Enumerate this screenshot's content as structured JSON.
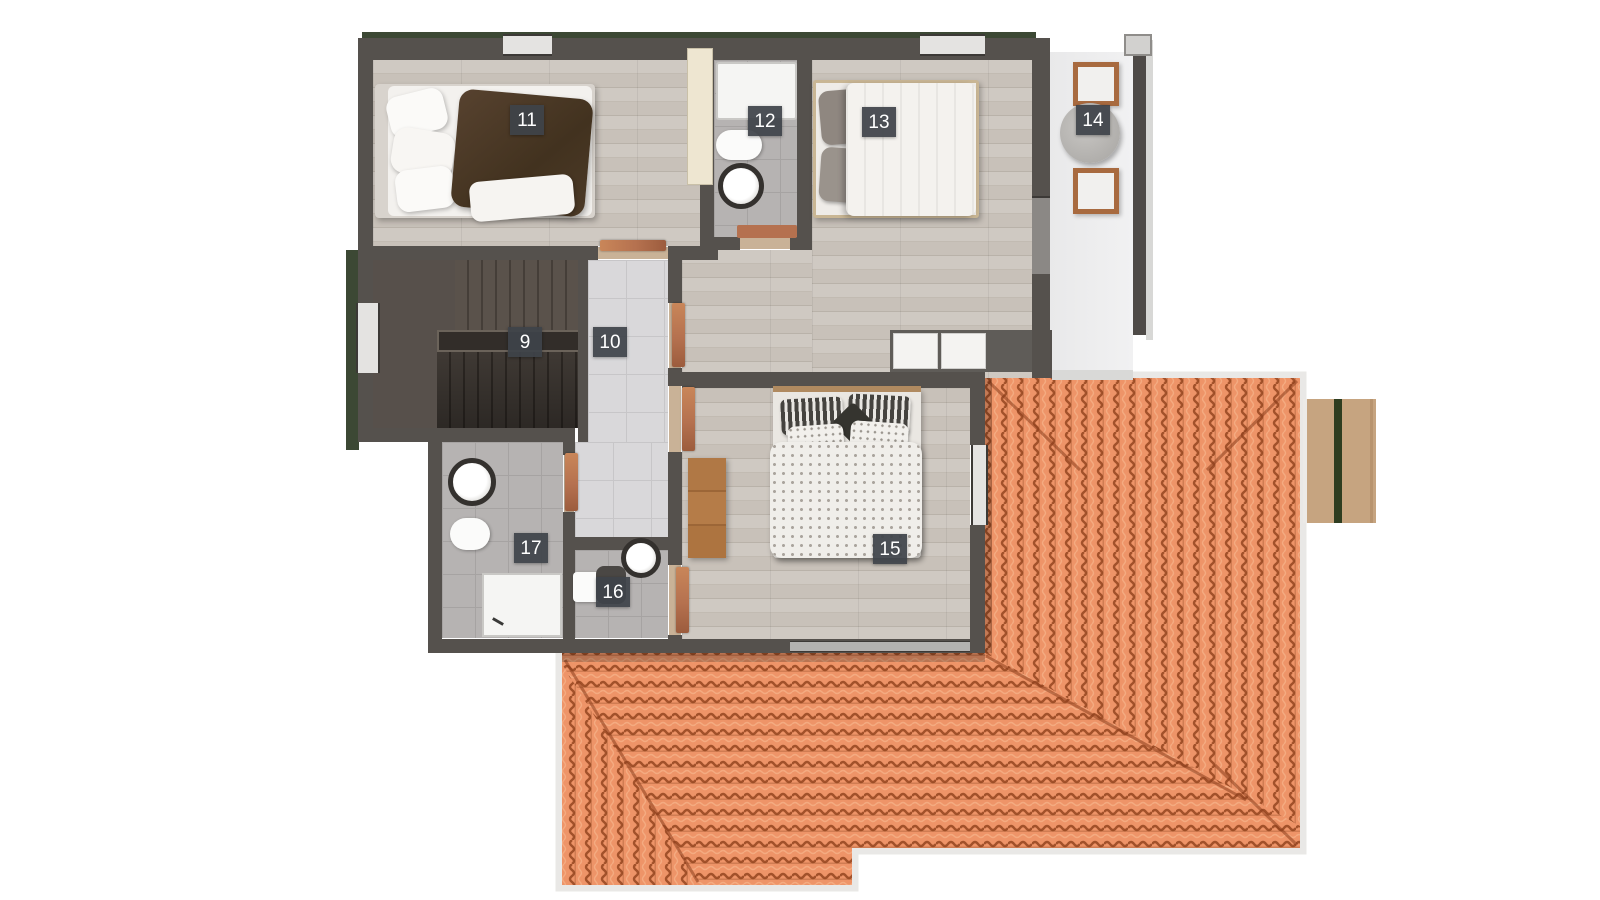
{
  "rooms": [
    {
      "label": "9",
      "kind": "staircase"
    },
    {
      "label": "10",
      "kind": "hallway"
    },
    {
      "label": "11",
      "kind": "bedroom with bed"
    },
    {
      "label": "12",
      "kind": "bathroom with tub, toilet, sink"
    },
    {
      "label": "13",
      "kind": "bedroom with double bed"
    },
    {
      "label": "14",
      "kind": "balcony with two chairs and table"
    },
    {
      "label": "15",
      "kind": "bedroom with double bed and dresser"
    },
    {
      "label": "16",
      "kind": "bathroom with toilet and sink"
    },
    {
      "label": "17",
      "kind": "bathroom with sink, toilet, shower"
    }
  ],
  "colors": {
    "roof_tile": "#ee9468",
    "roof_tile_shadow": "#a2512a",
    "roof_fascia": "#e9e8e6",
    "wall": "#55514d",
    "hedge_green": "#3c4834",
    "door_wood": "#b5714f",
    "deck_wood": "#c2a07d",
    "deck_stripe": "#2e3d20",
    "badge_background": "#3e4349",
    "badge_text": "#ffffff"
  }
}
